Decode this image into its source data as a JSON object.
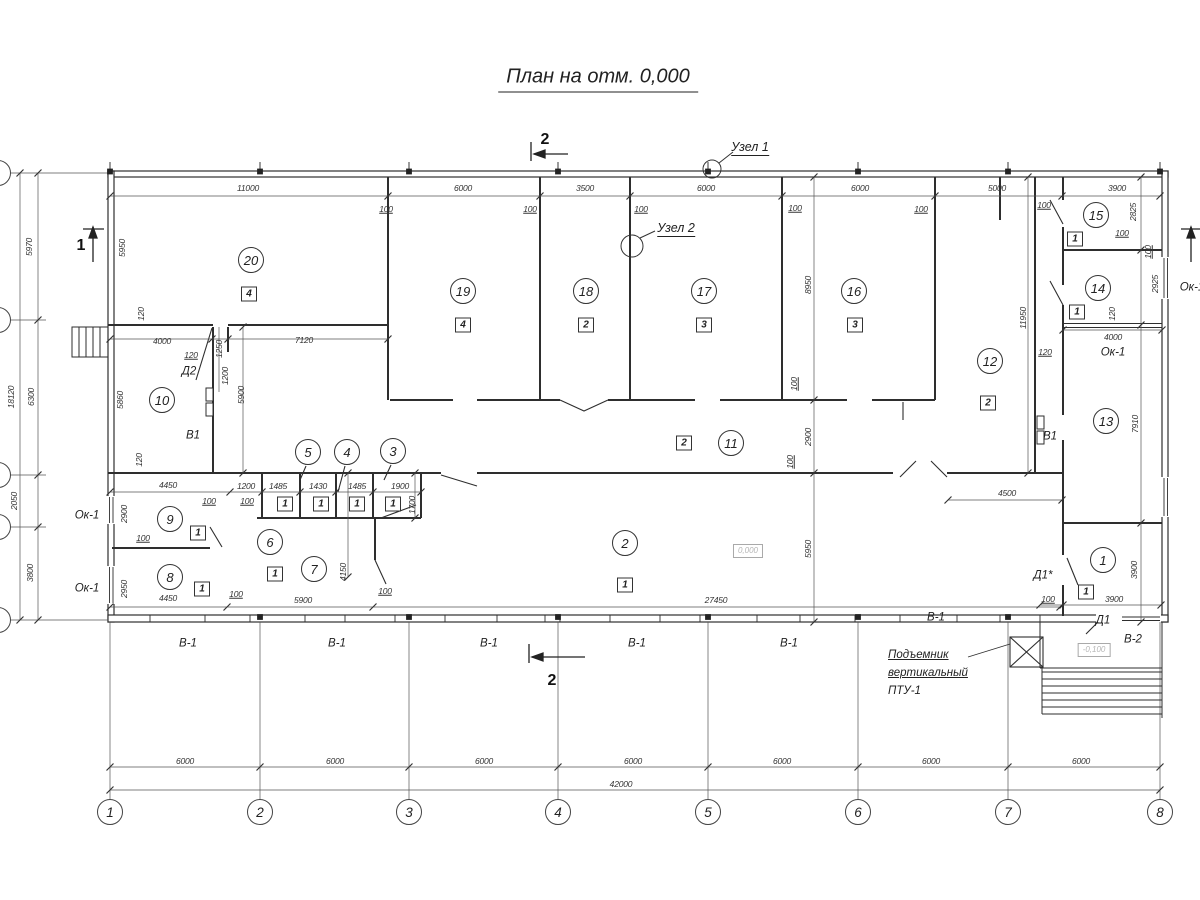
{
  "title": "План на отм. 0,000",
  "colors": {
    "line": "#2e2e2e",
    "dim_line": "#555555",
    "muted_text": "#b5b5b5",
    "background": "#ffffff"
  },
  "nodes": [
    {
      "label": "Узел 1",
      "x": 750,
      "y": 148
    },
    {
      "label": "Узел 2",
      "x": 676,
      "y": 229
    }
  ],
  "sections": {
    "top_label": "2",
    "bottom_label": "2",
    "left_label": "1"
  },
  "note": {
    "line1": "Подъемник",
    "line2": "вертикальный",
    "line3": "ПТУ-1"
  },
  "rooms": [
    {
      "n": "20",
      "x": 251,
      "y": 260
    },
    {
      "n": "19",
      "x": 463,
      "y": 291
    },
    {
      "n": "18",
      "x": 586,
      "y": 291
    },
    {
      "n": "17",
      "x": 704,
      "y": 291
    },
    {
      "n": "16",
      "x": 854,
      "y": 291
    },
    {
      "n": "15",
      "x": 1096,
      "y": 215
    },
    {
      "n": "14",
      "x": 1098,
      "y": 288
    },
    {
      "n": "13",
      "x": 1106,
      "y": 421
    },
    {
      "n": "12",
      "x": 990,
      "y": 361
    },
    {
      "n": "11",
      "x": 731,
      "y": 443
    },
    {
      "n": "10",
      "x": 162,
      "y": 400
    },
    {
      "n": "9",
      "x": 170,
      "y": 519
    },
    {
      "n": "8",
      "x": 170,
      "y": 577
    },
    {
      "n": "7",
      "x": 314,
      "y": 569
    },
    {
      "n": "6",
      "x": 270,
      "y": 542
    },
    {
      "n": "5",
      "x": 308,
      "y": 452
    },
    {
      "n": "4",
      "x": 347,
      "y": 452
    },
    {
      "n": "3",
      "x": 393,
      "y": 451
    },
    {
      "n": "2",
      "x": 625,
      "y": 543
    },
    {
      "n": "1",
      "x": 1103,
      "y": 560
    }
  ],
  "categories": [
    {
      "n": "4",
      "x": 249,
      "y": 294
    },
    {
      "n": "4",
      "x": 463,
      "y": 325
    },
    {
      "n": "2",
      "x": 586,
      "y": 325
    },
    {
      "n": "3",
      "x": 704,
      "y": 325
    },
    {
      "n": "3",
      "x": 855,
      "y": 325
    },
    {
      "n": "1",
      "x": 1075,
      "y": 239
    },
    {
      "n": "1",
      "x": 1077,
      "y": 312
    },
    {
      "n": "2",
      "x": 988,
      "y": 403
    },
    {
      "n": "2",
      "x": 684,
      "y": 443
    },
    {
      "n": "1",
      "x": 198,
      "y": 533
    },
    {
      "n": "1",
      "x": 202,
      "y": 589
    },
    {
      "n": "1",
      "x": 285,
      "y": 504
    },
    {
      "n": "1",
      "x": 321,
      "y": 504
    },
    {
      "n": "1",
      "x": 357,
      "y": 504
    },
    {
      "n": "1",
      "x": 393,
      "y": 504
    },
    {
      "n": "1",
      "x": 275,
      "y": 574
    },
    {
      "n": "1",
      "x": 625,
      "y": 585
    },
    {
      "n": "1",
      "x": 1086,
      "y": 592
    }
  ],
  "dims": [
    {
      "t": "11000",
      "x": 248,
      "y": 188
    },
    {
      "t": "6000",
      "x": 463,
      "y": 188
    },
    {
      "t": "3500",
      "x": 585,
      "y": 188
    },
    {
      "t": "6000",
      "x": 706,
      "y": 188
    },
    {
      "t": "6000",
      "x": 860,
      "y": 188
    },
    {
      "t": "5000",
      "x": 997,
      "y": 188
    },
    {
      "t": "3900",
      "x": 1117,
      "y": 188
    },
    {
      "t": "100",
      "x": 386,
      "y": 209,
      "u": 1
    },
    {
      "t": "100",
      "x": 530,
      "y": 209,
      "u": 1
    },
    {
      "t": "100",
      "x": 641,
      "y": 209,
      "u": 1
    },
    {
      "t": "100",
      "x": 795,
      "y": 208,
      "u": 1
    },
    {
      "t": "100",
      "x": 921,
      "y": 209,
      "u": 1
    },
    {
      "t": "100",
      "x": 1044,
      "y": 205,
      "u": 1
    },
    {
      "t": "5970",
      "x": 29,
      "y": 247,
      "r": 1
    },
    {
      "t": "6300",
      "x": 31,
      "y": 397,
      "r": 1
    },
    {
      "t": "2050",
      "x": 14,
      "y": 501,
      "r": 1
    },
    {
      "t": "3800",
      "x": 30,
      "y": 573,
      "r": 1
    },
    {
      "t": "18120",
      "x": 11,
      "y": 397,
      "r": 1
    },
    {
      "t": "5950",
      "x": 122,
      "y": 248,
      "r": 1
    },
    {
      "t": "120",
      "x": 141,
      "y": 314,
      "r": 1
    },
    {
      "t": "5860",
      "x": 120,
      "y": 400,
      "r": 1
    },
    {
      "t": "120",
      "x": 139,
      "y": 460,
      "r": 1
    },
    {
      "t": "2900",
      "x": 124,
      "y": 514,
      "r": 1
    },
    {
      "t": "2950",
      "x": 124,
      "y": 589,
      "r": 1
    },
    {
      "t": "4000",
      "x": 162,
      "y": 341
    },
    {
      "t": "7120",
      "x": 304,
      "y": 340
    },
    {
      "t": "120",
      "x": 191,
      "y": 355,
      "u": 1
    },
    {
      "t": "1250",
      "x": 219,
      "y": 349,
      "r": 1
    },
    {
      "t": "1200",
      "x": 225,
      "y": 376,
      "r": 1
    },
    {
      "t": "5900",
      "x": 241,
      "y": 395,
      "r": 1
    },
    {
      "t": "4450",
      "x": 168,
      "y": 485
    },
    {
      "t": "1200",
      "x": 246,
      "y": 486
    },
    {
      "t": "1485",
      "x": 278,
      "y": 486
    },
    {
      "t": "1430",
      "x": 318,
      "y": 486
    },
    {
      "t": "1485",
      "x": 357,
      "y": 486
    },
    {
      "t": "1900",
      "x": 400,
      "y": 486
    },
    {
      "t": "1700",
      "x": 412,
      "y": 505,
      "r": 1
    },
    {
      "t": "100",
      "x": 209,
      "y": 501,
      "u": 1
    },
    {
      "t": "100",
      "x": 247,
      "y": 501,
      "u": 1
    },
    {
      "t": "100",
      "x": 143,
      "y": 538,
      "u": 1
    },
    {
      "t": "4450",
      "x": 168,
      "y": 598
    },
    {
      "t": "100",
      "x": 236,
      "y": 594,
      "u": 1
    },
    {
      "t": "5900",
      "x": 303,
      "y": 600
    },
    {
      "t": "100",
      "x": 385,
      "y": 591,
      "u": 1
    },
    {
      "t": "4150",
      "x": 343,
      "y": 572,
      "r": 1
    },
    {
      "t": "27450",
      "x": 716,
      "y": 600
    },
    {
      "t": "5950",
      "x": 808,
      "y": 549,
      "r": 1
    },
    {
      "t": "100",
      "x": 790,
      "y": 462,
      "r": 1,
      "u": 1
    },
    {
      "t": "2900",
      "x": 808,
      "y": 437,
      "r": 1
    },
    {
      "t": "100",
      "x": 794,
      "y": 384,
      "r": 1,
      "u": 1
    },
    {
      "t": "8950",
      "x": 808,
      "y": 285,
      "r": 1
    },
    {
      "t": "11950",
      "x": 1023,
      "y": 318,
      "r": 1
    },
    {
      "t": "120",
      "x": 1045,
      "y": 352,
      "u": 1
    },
    {
      "t": "4500",
      "x": 1007,
      "y": 493
    },
    {
      "t": "2825",
      "x": 1133,
      "y": 212,
      "r": 1
    },
    {
      "t": "100",
      "x": 1148,
      "y": 252,
      "r": 1,
      "u": 1
    },
    {
      "t": "2925",
      "x": 1155,
      "y": 284,
      "r": 1
    },
    {
      "t": "120",
      "x": 1112,
      "y": 314,
      "r": 1
    },
    {
      "t": "4000",
      "x": 1113,
      "y": 337
    },
    {
      "t": "100",
      "x": 1122,
      "y": 233,
      "u": 1
    },
    {
      "t": "7910",
      "x": 1135,
      "y": 424,
      "r": 1
    },
    {
      "t": "100",
      "x": 1048,
      "y": 599,
      "u": 1
    },
    {
      "t": "3900",
      "x": 1114,
      "y": 599
    },
    {
      "t": "3900",
      "x": 1134,
      "y": 570,
      "r": 1
    },
    {
      "t": "6000",
      "x": 185,
      "y": 761
    },
    {
      "t": "6000",
      "x": 335,
      "y": 761
    },
    {
      "t": "6000",
      "x": 484,
      "y": 761
    },
    {
      "t": "6000",
      "x": 633,
      "y": 761
    },
    {
      "t": "6000",
      "x": 782,
      "y": 761
    },
    {
      "t": "6000",
      "x": 931,
      "y": 761
    },
    {
      "t": "6000",
      "x": 1081,
      "y": 761
    },
    {
      "t": "42000",
      "x": 621,
      "y": 784
    }
  ],
  "labels": [
    {
      "t": "Д2",
      "x": 189,
      "y": 372
    },
    {
      "t": "В1",
      "x": 193,
      "y": 436
    },
    {
      "t": "В1",
      "x": 1050,
      "y": 437
    },
    {
      "t": "Ок-1",
      "x": 87,
      "y": 516
    },
    {
      "t": "Ок-1",
      "x": 87,
      "y": 589
    },
    {
      "t": "Ок-1",
      "x": 1113,
      "y": 353
    },
    {
      "t": "Ок-1",
      "x": 1192,
      "y": 288
    },
    {
      "t": "Д1*",
      "x": 1043,
      "y": 576
    },
    {
      "t": "Д1",
      "x": 1103,
      "y": 621
    },
    {
      "t": "В-2",
      "x": 1133,
      "y": 640
    },
    {
      "t": "В-1",
      "x": 188,
      "y": 644
    },
    {
      "t": "В-1",
      "x": 337,
      "y": 644
    },
    {
      "t": "В-1",
      "x": 489,
      "y": 644
    },
    {
      "t": "В-1",
      "x": 637,
      "y": 644
    },
    {
      "t": "В-1",
      "x": 789,
      "y": 644
    },
    {
      "t": "В-1",
      "x": 936,
      "y": 618
    }
  ],
  "elevations": [
    {
      "t": "0,000",
      "x": 748,
      "y": 551
    },
    {
      "t": "-0,100",
      "x": 1094,
      "y": 650
    }
  ],
  "grid_bottom": {
    "bubble_y": 812,
    "bubbles": [
      {
        "n": "1",
        "x": 110
      },
      {
        "n": "2",
        "x": 260
      },
      {
        "n": "3",
        "x": 409
      },
      {
        "n": "4",
        "x": 558
      },
      {
        "n": "5",
        "x": 708
      },
      {
        "n": "6",
        "x": 858
      },
      {
        "n": "7",
        "x": 1008
      },
      {
        "n": "8",
        "x": 1160
      }
    ]
  },
  "grid_left": {
    "bubble_ys": [
      173,
      320,
      475,
      527,
      620
    ]
  }
}
